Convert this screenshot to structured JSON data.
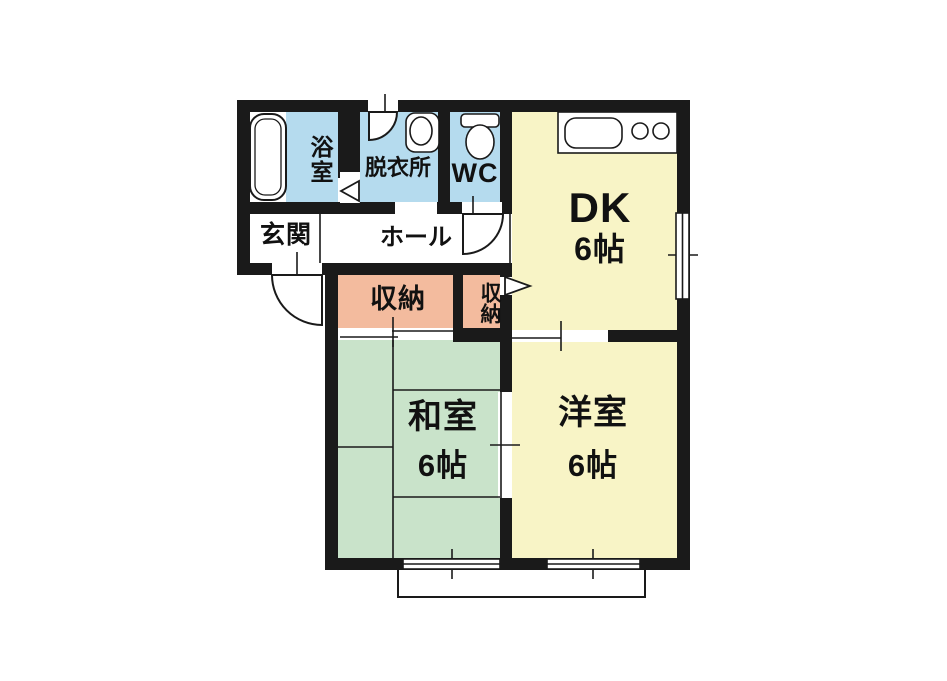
{
  "plan": {
    "type": "floor-plan",
    "rooms": {
      "bath": {
        "label": "浴室"
      },
      "dressing": {
        "label": "脱衣所"
      },
      "wc": {
        "label": "WC"
      },
      "dk": {
        "label": "DK",
        "size": "6帖"
      },
      "entrance": {
        "label": "玄関"
      },
      "hall": {
        "label": "ホール"
      },
      "storage_large": {
        "label": "収納"
      },
      "storage_small": {
        "label": "収納"
      },
      "japanese_room": {
        "label": "和室",
        "size": "6帖"
      },
      "western_room": {
        "label": "洋室",
        "size": "6帖"
      }
    },
    "colors": {
      "wall": "#1a1a1a",
      "wet_area": "#b5dbee",
      "living_area": "#f8f4c6",
      "storage": "#f3bb9e",
      "tatami": "#c9e3ca",
      "fixture": "#ffffff",
      "background": "#ffffff"
    }
  }
}
